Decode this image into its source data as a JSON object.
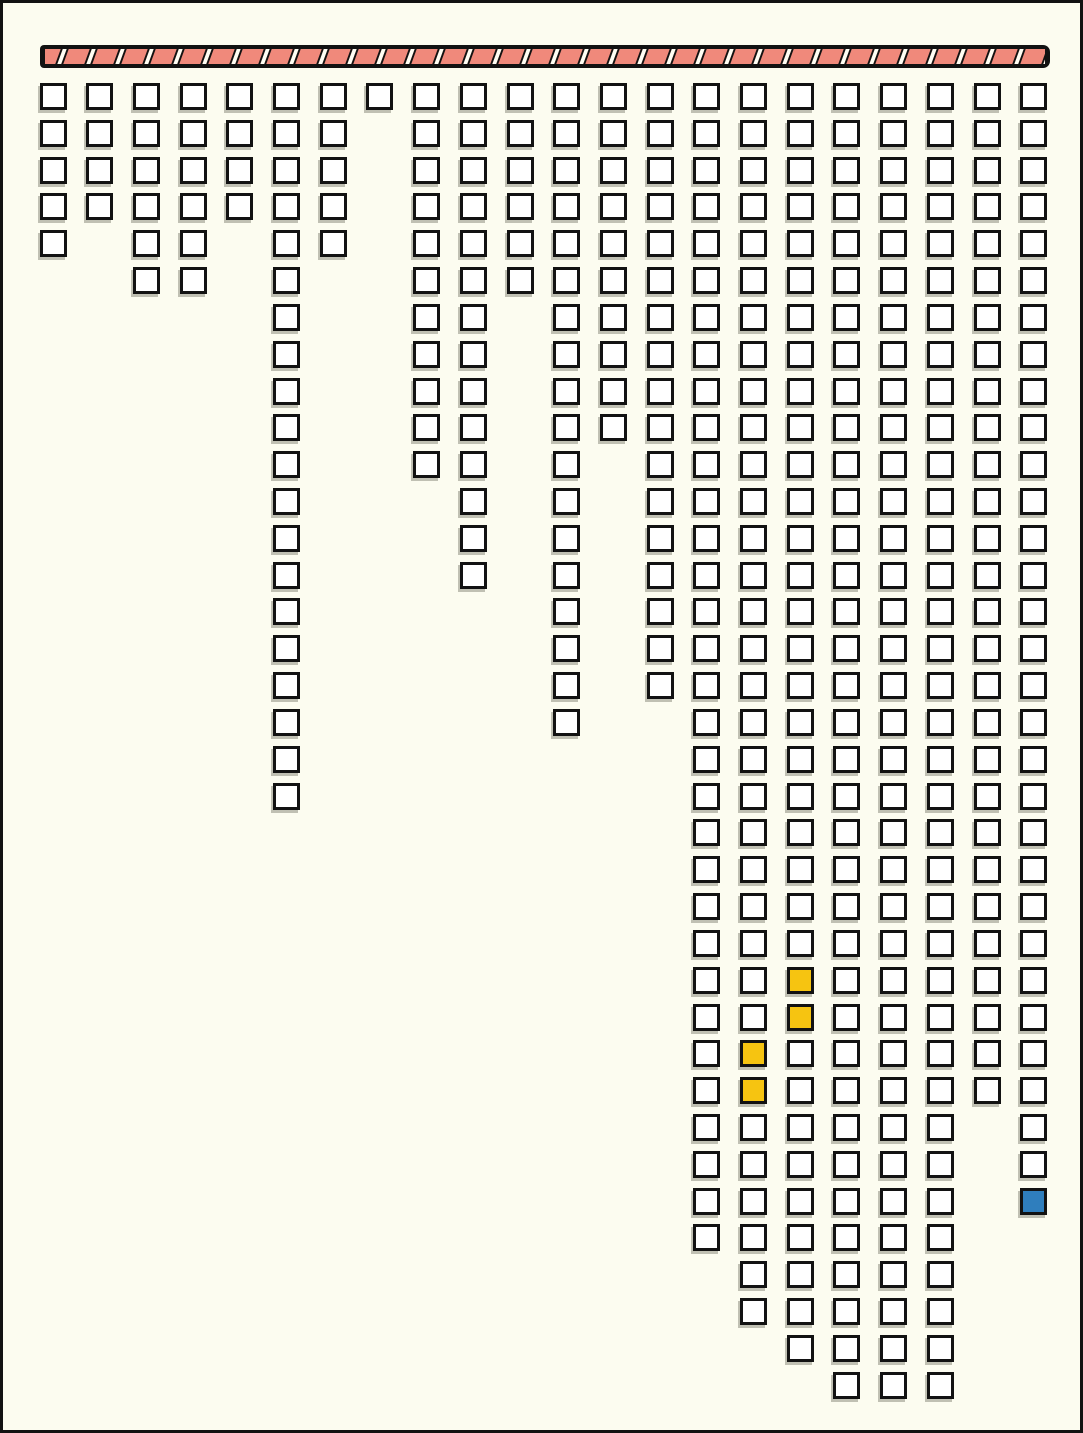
{
  "figure": {
    "description": "Hand-drawn style unit chart: a hatched horizontal bar along the top with 22 columns of small outlined squares hanging below it; four squares highlighted yellow and one highlighted blue",
    "colors": {
      "background": "#FCFCF0",
      "ink": "#121212",
      "bar_fill": "#F0897B",
      "bar_gap": "#FFFEF4",
      "cell_fill": "#FFFFFF",
      "highlight_yellow": "#F6C411",
      "highlight_blue": "#2F7EBD"
    }
  },
  "chart_data": {
    "type": "bar",
    "style": "unit-waffle-columns-hanging-from-top-bar",
    "title": "",
    "xlabel": "",
    "ylabel": "",
    "categories": [
      "col1",
      "col2",
      "col3",
      "col4",
      "col5",
      "col6",
      "col7",
      "col8",
      "col9",
      "col10",
      "col11",
      "col12",
      "col13",
      "col14",
      "col15",
      "col16",
      "col17",
      "col18",
      "col19",
      "col20",
      "col21",
      "col22"
    ],
    "values": [
      5,
      4,
      6,
      6,
      4,
      20,
      5,
      1,
      11,
      14,
      6,
      18,
      10,
      17,
      32,
      34,
      35,
      36,
      36,
      36,
      28,
      31
    ],
    "total_units": 395,
    "max_rows": 36,
    "highlights": [
      {
        "column": 16,
        "rows": [
          27,
          28
        ],
        "color": "yellow"
      },
      {
        "column": 17,
        "rows": [
          25,
          26
        ],
        "color": "yellow"
      },
      {
        "column": 22,
        "rows": [
          31
        ],
        "color": "blue"
      }
    ],
    "legend": "none",
    "grid": "off",
    "hatch_bar_segments": 34
  }
}
